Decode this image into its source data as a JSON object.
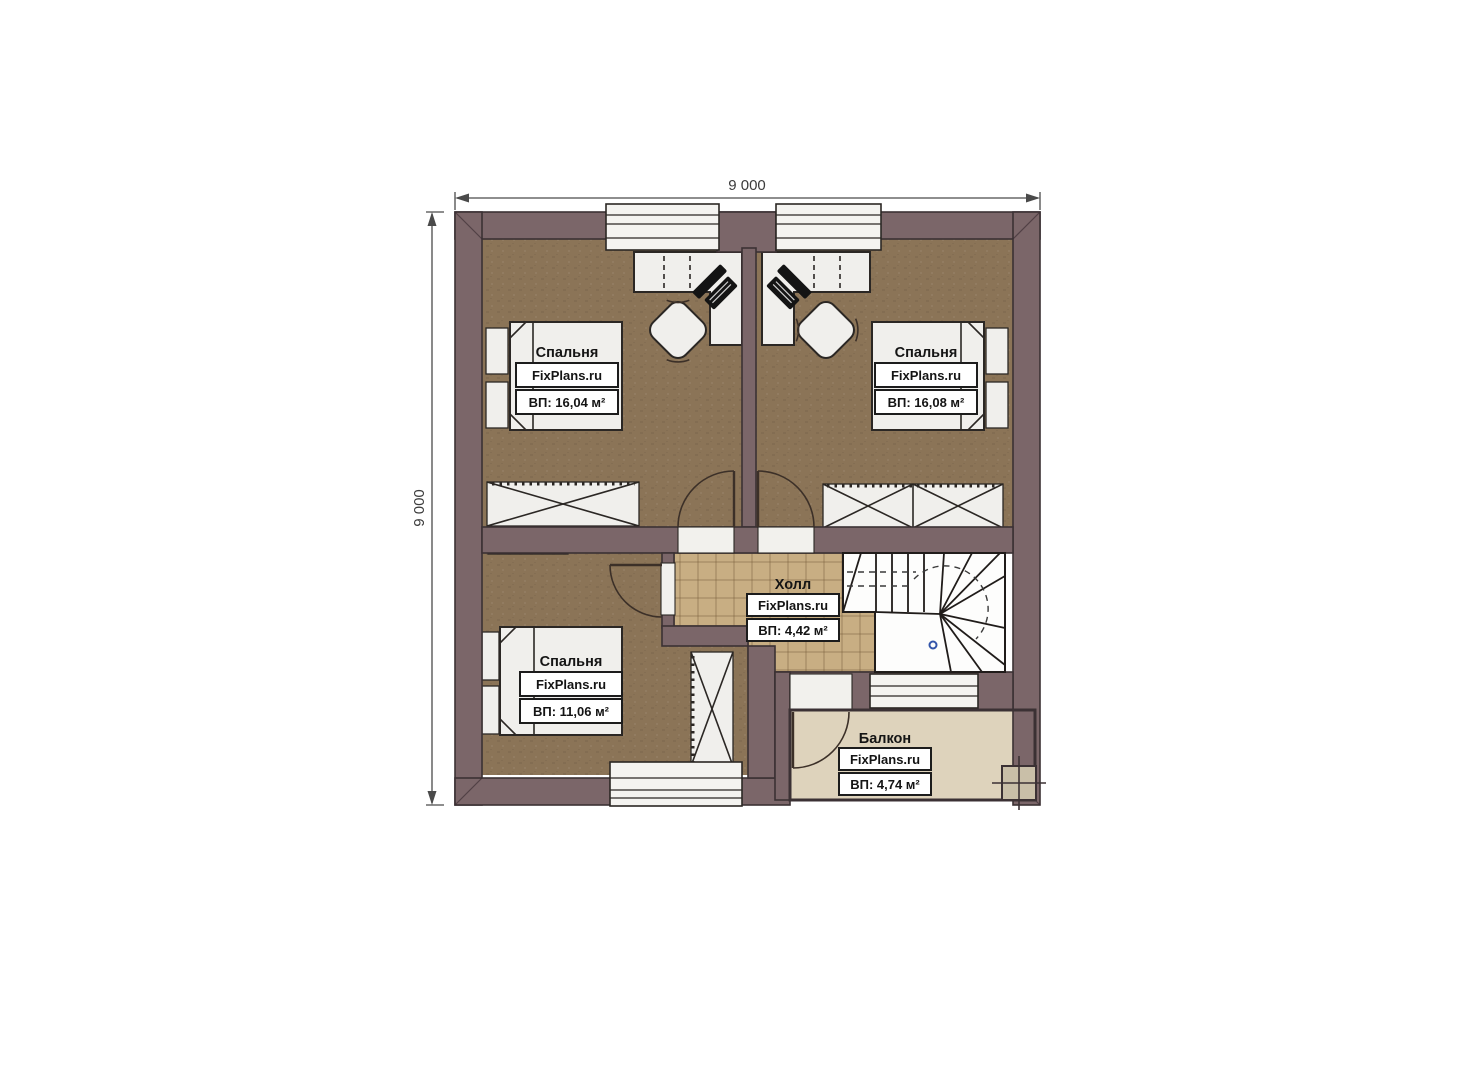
{
  "plan": {
    "dimension_top": "9 000",
    "dimension_left": "9 000",
    "rooms": {
      "bedroom_tl": {
        "name": "Спальня",
        "brand": "FixPlans.ru",
        "area": "ВП: 16,04 м²"
      },
      "bedroom_tr": {
        "name": "Спальня",
        "brand": "FixPlans.ru",
        "area": "ВП: 16,08 м²"
      },
      "bedroom_bl": {
        "name": "Спальня",
        "brand": "FixPlans.ru",
        "area": "ВП: 11,06 м²"
      },
      "hall": {
        "name": "Холл",
        "brand": "FixPlans.ru",
        "area": "ВП: 4,42 м²"
      },
      "balcony": {
        "name": "Балкон",
        "brand": "FixPlans.ru",
        "area": "ВП: 4,74 м²"
      }
    },
    "colors": {
      "wall": "#7b6669",
      "outline": "#3b3134",
      "floor_room": "#8b7457",
      "floor_hall": "#c8ae83",
      "floor_balcony": "#ded3bc",
      "furniture": "#f0efec",
      "stair_marker": "#3355aa"
    }
  }
}
